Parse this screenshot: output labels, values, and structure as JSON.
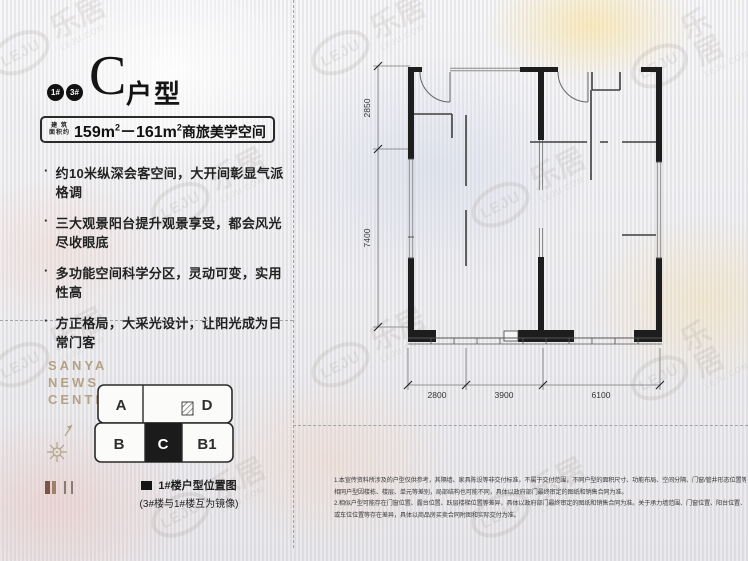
{
  "watermark": {
    "brand": "乐居",
    "logo": "LEJU",
    "site": "LEJU.COM"
  },
  "header": {
    "badges": [
      "1#",
      "3#"
    ],
    "title_main": "C",
    "title_suffix": "户型",
    "area": {
      "label_top": "建 筑",
      "label_bottom": "面积约",
      "num1": "159m",
      "sup1": "2",
      "sep": "－",
      "num2": "161m",
      "sup2": "2",
      "desc": "商旅美学空间"
    }
  },
  "features": {
    "bullet": "·",
    "items": [
      "约10米纵深会客空间，大开间彰显气派格调",
      "三大观景阳台提升观景享受，都会风光尽收眼底",
      "多功能空间科学分区，灵动可变，实用性高",
      "方正格局，大采光设计，让阳光成为日常门客"
    ]
  },
  "brand": {
    "line1": "SANYA",
    "line2": "NEWS",
    "line3": "CENTER"
  },
  "unit_map": {
    "units_top": [
      "A",
      "D"
    ],
    "units_bottom": [
      "B",
      "C",
      "B1"
    ],
    "highlighted_unit": "C",
    "legend_title": "1#楼户型位置图",
    "legend_note": "(3#楼与1#楼互为镜像)"
  },
  "floor_plan": {
    "dim_left_top": "2850",
    "dim_left_bottom": "7400",
    "dim_bottom": [
      "2800",
      "3900",
      "6100"
    ]
  },
  "disclaimer": {
    "line1": "1.本宣传资料所涉及的户型仅供参考，其隔墙、家具陈设等非交付标准，不属于交付范围，不同户型的面积尺寸、功能布局、空间分隔、门窗/管井形态位置等均有不同；",
    "line2": "相同户型因楼栋、楼层、单元等差别，局部结构也可能不同，具体以政府部门最终审定的图纸和销售合同为准。",
    "line3": "2.相似户型可能存在门窗位置、露台位置、跃层楼梯位置等差异，具体以政府部门最终审定的图纸和销售合同为准。关于承力墙范围、门窗位置、阳台位置、跃层楼梯位置",
    "line4": "或车位位置等存在差异，具体以商品房买卖合同附图和实际交付为准。"
  }
}
